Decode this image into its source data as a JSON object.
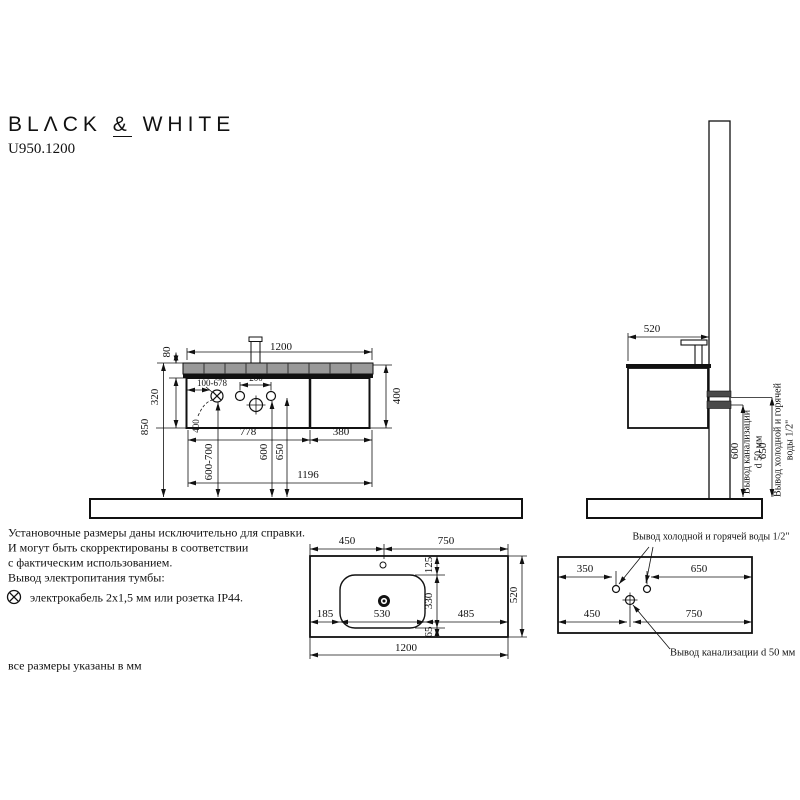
{
  "header": {
    "brand_a": "BLΛCK",
    "amp": "&",
    "brand_b": "WHITE",
    "model": "U950.1200"
  },
  "front": {
    "width": "1200",
    "strip_height": "80",
    "body_height": "320",
    "total_height": "850",
    "cabinet_height": "400",
    "socket_range": "100-678",
    "hole_spacing": "200",
    "socket_note": "400",
    "left_section": "778",
    "right_section": "380",
    "socket_floor": "600-700",
    "drain_floor": "600",
    "water_floor": "650",
    "bottom_width": "1196"
  },
  "side": {
    "depth": "520",
    "drain_height": "600",
    "water_height": "650",
    "drain_l1": "Вывод канализации",
    "drain_l2": "d 50 мм",
    "water_l1": "Вывод холодной и горячей",
    "water_l2": "воды 1/2\""
  },
  "sink": {
    "a450": "450",
    "a750": "750",
    "a125": "125",
    "a330": "330",
    "a65": "65",
    "a185": "185",
    "a530": "530",
    "a485": "485",
    "a520": "520",
    "a1200": "1200"
  },
  "wall": {
    "title": "Вывод холодной и горячей воды 1/2\"",
    "a350": "350",
    "a650": "650",
    "a450": "450",
    "a750": "750",
    "drain_label": "Вывод канализации d 50 мм"
  },
  "notes": {
    "l1": "Установочные размеры даны исключительно для справки.",
    "l2": "И могут быть скорректированы в соответствии",
    "l3": "с фактическим использованием.",
    "l4": "Вывод электропитания тумбы:",
    "l5": "электрокабель 2х1,5 мм или розетка IP44.",
    "footer": "все размеры указаны в мм"
  },
  "colors": {
    "line": "#111111",
    "strip": "#999999",
    "pipe": "#4a4a4a"
  }
}
